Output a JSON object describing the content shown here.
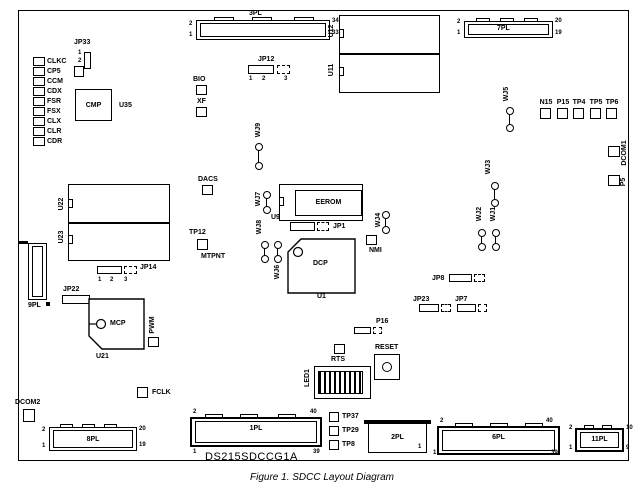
{
  "colors": {
    "ink": "#000000",
    "paper": "#ffffff"
  },
  "caption": "Figure 1. SDCC Layout Diagram",
  "board_name": "DS215SDCCG1A",
  "tp_left": [
    "CLKC",
    "CP5",
    "CCM",
    "CDX",
    "FSR",
    "FSX",
    "CLX",
    "CLR",
    "CDR"
  ],
  "tp_topright": [
    "N15",
    "P15",
    "TP4",
    "TP5",
    "TP6"
  ],
  "tp": {
    "bio": "BIO",
    "xf": "XF",
    "dacs": "DACS",
    "tp12": "TP12",
    "mtpnt": "MTPNT",
    "nmi": "NMI",
    "rts": "RTS",
    "fclk": "FCLK",
    "pwm": "PWM",
    "dcom1": "DCOM1",
    "p5": "P5",
    "dcom2": "DCOM2",
    "tp37": "TP37",
    "tp29": "TP29",
    "tp8": "TP8"
  },
  "ics": {
    "cmp": "CMP",
    "u35": "U35",
    "u12": "U12",
    "u11": "U11",
    "u22": "U22",
    "u23": "U23",
    "mcp": "MCP",
    "u21": "U21",
    "dcp": "DCP",
    "u1": "U1",
    "eerom": "EEROM",
    "u9": "U9",
    "led1": "LED1"
  },
  "jumpers": {
    "jp33": {
      "label": "JP33",
      "pins": [
        "1",
        "2"
      ]
    },
    "jp12": {
      "label": "JP12",
      "pins": [
        "1",
        "2",
        "3"
      ]
    },
    "jp14": {
      "label": "JP14",
      "pins": [
        "1",
        "2",
        "3"
      ]
    },
    "jp1": {
      "label": "JP1"
    },
    "jp22": {
      "label": "JP22"
    },
    "jp8": {
      "label": "JP8"
    },
    "jp23": {
      "label": "JP23"
    },
    "jp7": {
      "label": "JP7"
    },
    "p16": {
      "label": "P16"
    }
  },
  "wire_jumpers": {
    "wj1": "WJ1",
    "wj2": "WJ2",
    "wj3": "WJ3",
    "wj4": "WJ4",
    "wj5": "WJ5",
    "wj6": "WJ6",
    "wj7": "WJ7",
    "wj8": "WJ8",
    "wj9": "WJ9"
  },
  "reset": {
    "label": "RESET"
  },
  "connectors": {
    "pl3": {
      "label": "3PL",
      "pin_tl": "2",
      "pin_bl": "1",
      "pin_tr": "34",
      "pin_br": "33"
    },
    "pl7": {
      "label": "7PL",
      "pin_tl": "2",
      "pin_bl": "1",
      "pin_tr": "20",
      "pin_br": "19"
    },
    "pl9": {
      "label": "9PL"
    },
    "pl8": {
      "label": "8PL",
      "pin_tl": "2",
      "pin_bl": "1",
      "pin_tr": "20",
      "pin_br": "19"
    },
    "pl1": {
      "label": "1PL",
      "pin_tl": "2",
      "pin_bl": "1",
      "pin_tr": "40",
      "pin_br": "39"
    },
    "pl2": {
      "label": "2PL",
      "pin_br": "1"
    },
    "pl6": {
      "label": "6PL",
      "pin_tl": "2",
      "pin_bl": "1",
      "pin_tr": "40",
      "pin_br": "39"
    },
    "pl11": {
      "label": "11PL",
      "pin_tl": "2",
      "pin_bl": "1",
      "pin_tr": "10",
      "pin_br": "9"
    }
  }
}
